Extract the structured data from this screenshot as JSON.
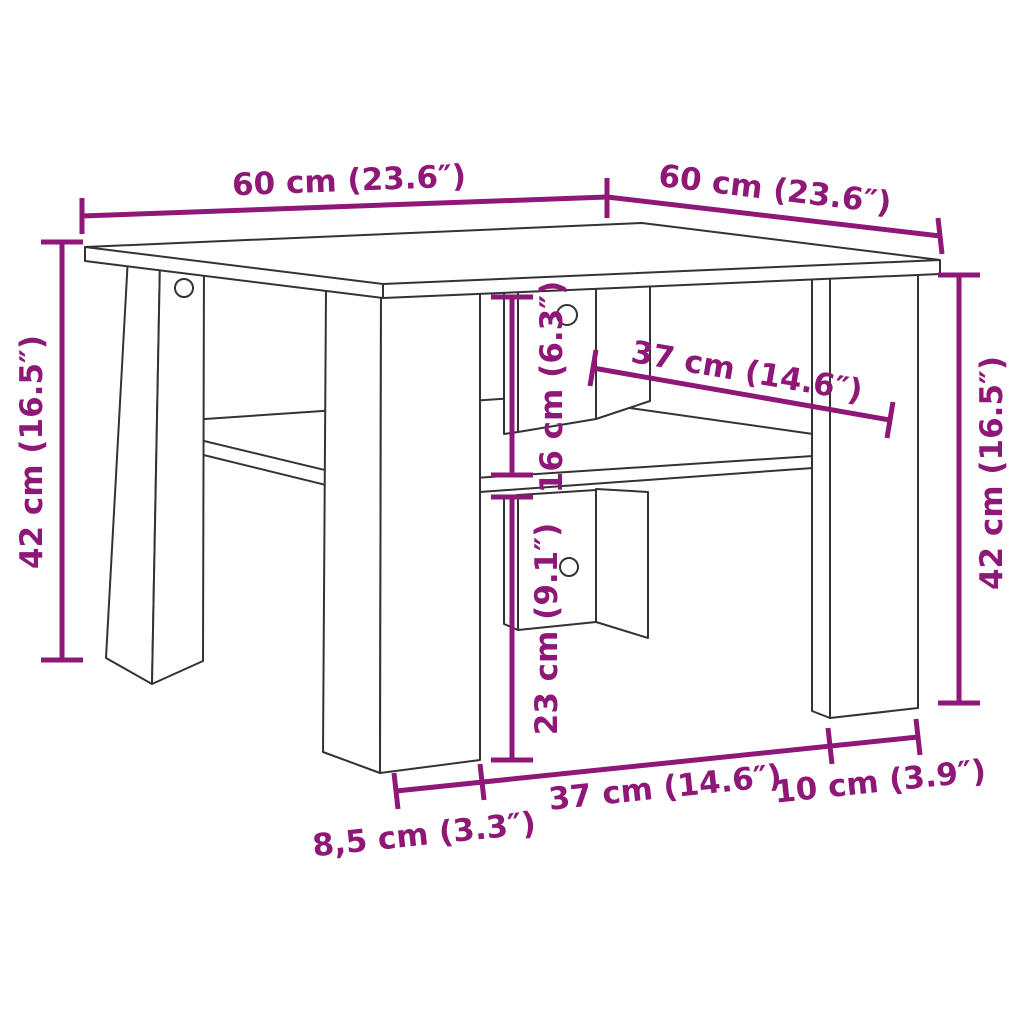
{
  "diagram": {
    "subject": "square coffee table with lower shelf, center support panels and four corner panel legs",
    "view": "perspective line drawing with dimension annotations",
    "colors": {
      "dimension": "#8E1777",
      "drawing": "#333333",
      "background": "#ffffff"
    },
    "labels": {
      "top_width": "60 cm (23.6″)",
      "top_depth": "60 cm (23.6″)",
      "height_left": "42 cm (16.5″)",
      "height_right": "42 cm (16.5″)",
      "shelf_span": "37 cm (14.6″)",
      "top_to_shelf": "16 cm (6.3″)",
      "shelf_to_floor": "23 cm (9.1″)",
      "base_span": "37 cm (14.6″)",
      "leg_depth_right": "10 cm (3.9″)",
      "leg_depth_left": "8,5 cm (3.3″)"
    }
  }
}
